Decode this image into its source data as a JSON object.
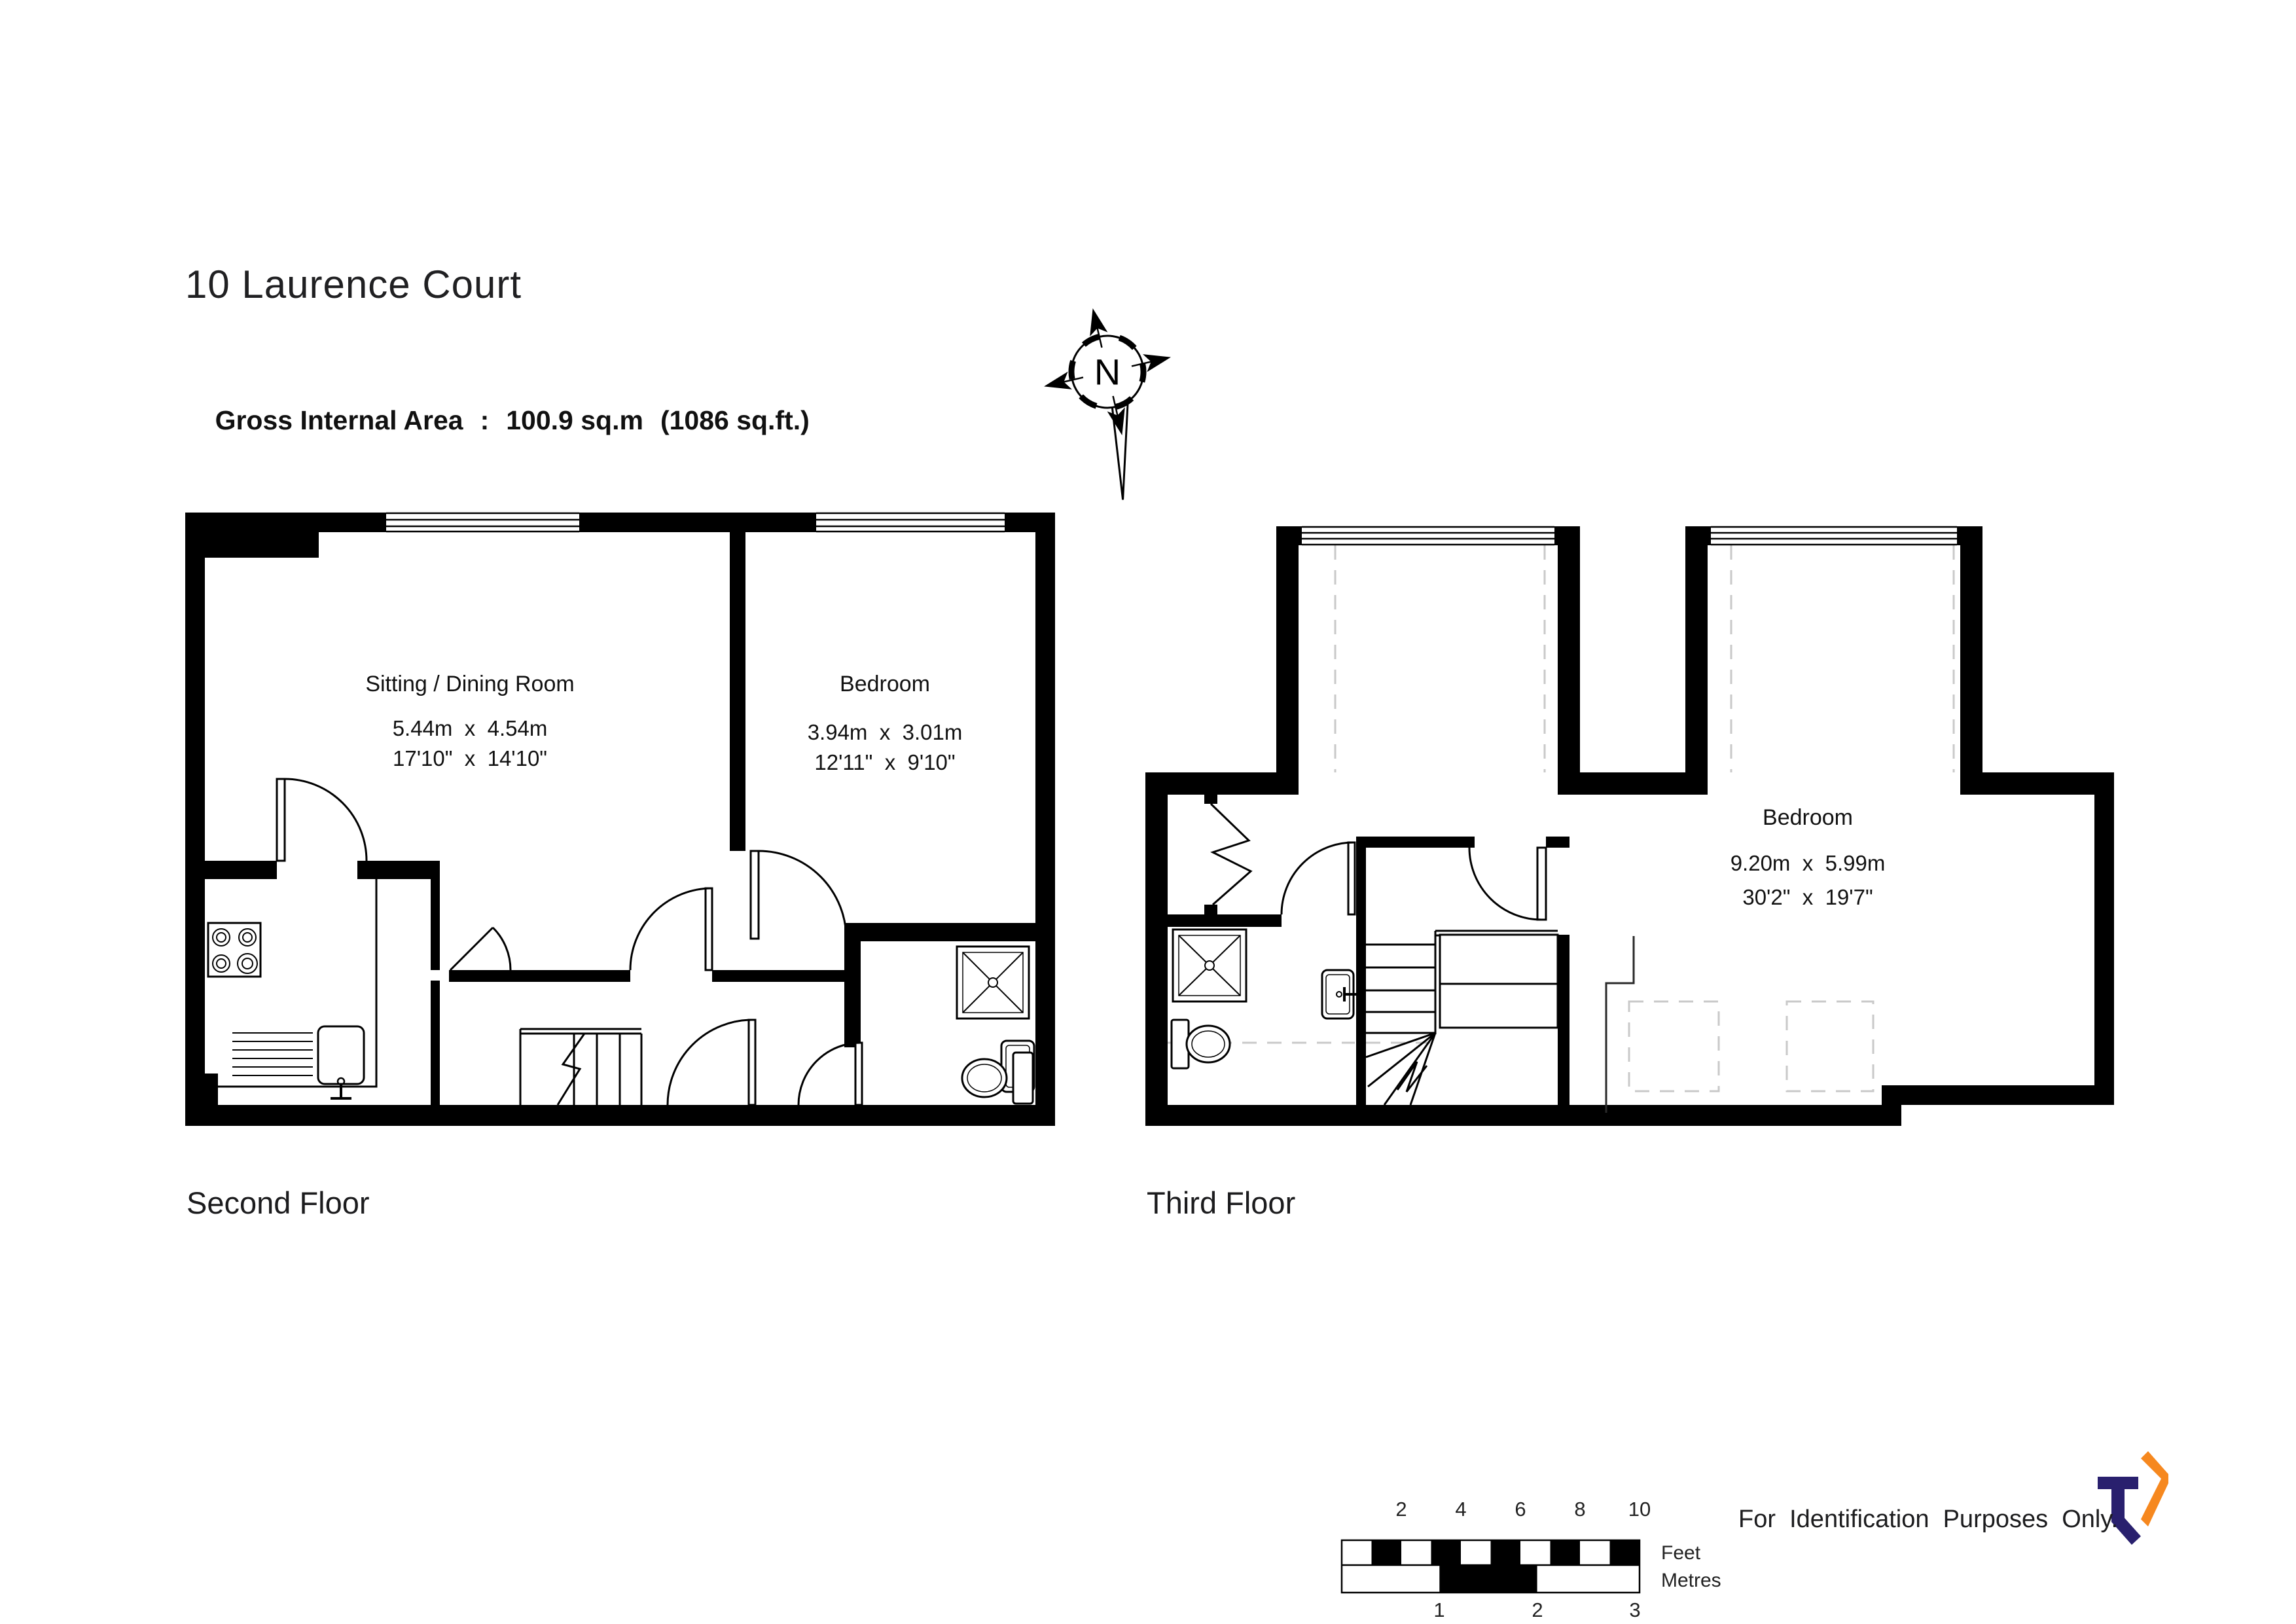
{
  "page": {
    "title": "10 Laurence Court"
  },
  "area": {
    "label": "Gross Internal Area",
    "separator": ":",
    "metric": "100.9 sq.m",
    "imperial": "(1086 sq.ft.)"
  },
  "compass": {
    "north": "N"
  },
  "floors": [
    {
      "name": "Second Floor",
      "rooms": [
        {
          "name": "Sitting / Dining Room",
          "metric": "5.44m  x  4.54m",
          "imperial": "17'10\"  x  14'10\""
        },
        {
          "name": "Bedroom",
          "metric": "3.94m  x  3.01m",
          "imperial": "12'11\"  x  9'10\""
        }
      ]
    },
    {
      "name": "Third Floor",
      "rooms": [
        {
          "name": "Bedroom",
          "metric": "9.20m  x  5.99m",
          "imperial": "30'2\"  x  19'7\""
        }
      ]
    }
  ],
  "scale_bar": {
    "feet_label": "Feet",
    "metres_label": "Metres",
    "feet_ticks": [
      "2",
      "4",
      "6",
      "8",
      "10"
    ],
    "metre_ticks": [
      "1",
      "2",
      "3"
    ]
  },
  "footer": {
    "purpose": "For  Identification  Purposes  Only.",
    "copyright": "©",
    "credit": "2025 Trueplan (UK) Limited  (01892) 614 881"
  },
  "colors": {
    "ink": "#000000",
    "dashed": "#c9c9c9",
    "logo_navy": "#29206e",
    "logo_orange": "#f6881f"
  }
}
